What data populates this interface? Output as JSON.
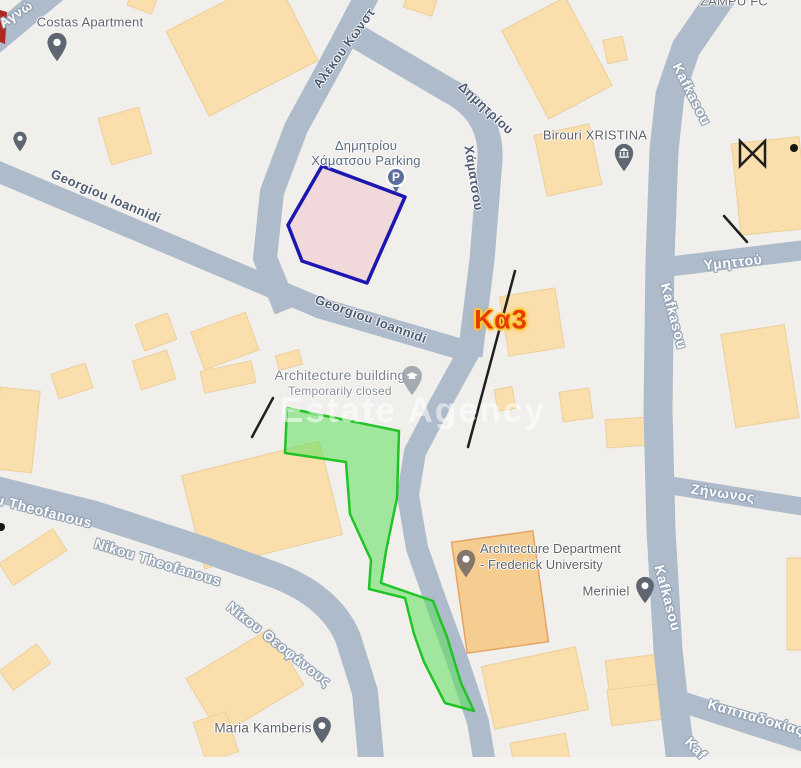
{
  "colors": {
    "background": "#f1efec",
    "road": "#aebbca",
    "building_fill": "#fadfad",
    "building_outline": "#eccf9b",
    "poi_building_fill": "#f6cd90",
    "poi_building_outline": "#e7a366",
    "parking_plot_stroke": "#1c17b0",
    "parking_plot_fill": "#eeb8c4",
    "green_plot_stroke": "#21c426",
    "green_plot_fill": "#5ce05c",
    "annotation_line": "#1f1f1f",
    "region_label_color": "#e63c00",
    "region_label_halo": "#ffc93c"
  },
  "overlay": {
    "region_label": "Κα3",
    "watermark": "Estate Agency",
    "parking_icon_letter": "P"
  },
  "pois": {
    "costas_apartment": "Costas Apartment",
    "parking_line1": "Δημητρίου",
    "parking_line2": "Χάματσου Parking",
    "zampu_fc": "ZAMPU FC",
    "birouri_xristina": "Birouri XRISTINA",
    "architecture_building": "Architecture building",
    "architecture_building_status": "Temporarily closed",
    "architecture_department_line1": "Architecture Department",
    "architecture_department_line2": "- Frederick University",
    "meriniel": "Meriniel",
    "maria_kamberis": "Maria Kamberis"
  },
  "streets": {
    "agno": "Αγνώ",
    "georgiou_upper": "Georgiou Ioannidi",
    "georgiou_lower": "Georgiou Ioannidi",
    "alekou": "Αλέκου Κωνστ",
    "dimitriou_line1": "Δημητρίου",
    "dimitriou_line2": "Χάματσου",
    "kafkasou_top": "Kafkasou",
    "kafkasou_middle": "Kafkasou",
    "kafkasou_lower": "Kafkasou",
    "kafkasou_bottom": "Kaf",
    "ymittou": "Υμηττού",
    "zinonos": "Ζήνωνος",
    "kappadokias": "Καππαδοκίας",
    "nikou_west": "u Theofanous",
    "nikou_mid": "Nikou Theofanous",
    "nikou_greek": "Νίκου Θεοφάνους"
  }
}
